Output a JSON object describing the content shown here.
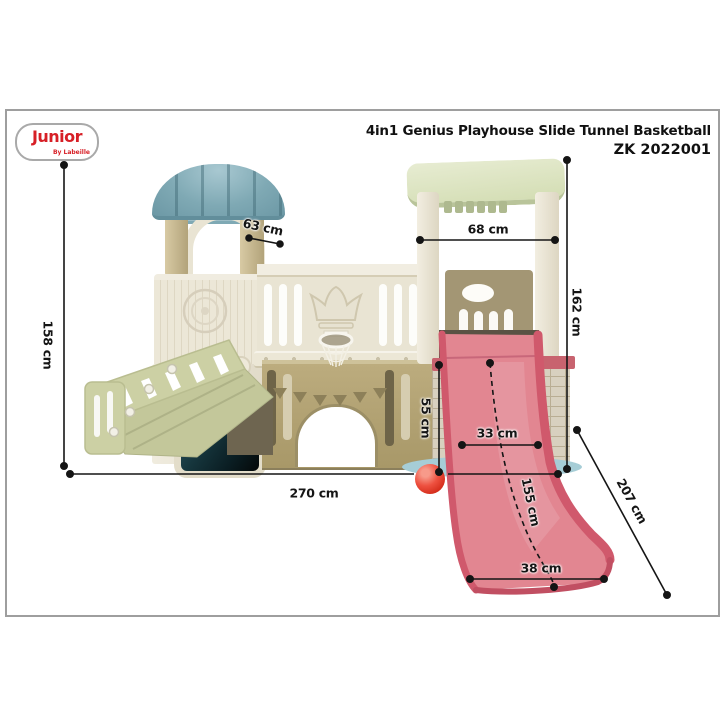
{
  "brand": {
    "logo_text": "Junior",
    "logo_tagline": "By Labeille",
    "logo_color": "#d71f26"
  },
  "header": {
    "title_line1": "4in1 Genius Playhouse Slide Tunnel Basketball",
    "title_line2": "ZK 2022001"
  },
  "product": {
    "tower_plaque": "1616",
    "features": [
      "playhouse",
      "slide",
      "tunnel",
      "basketball"
    ]
  },
  "dimensions": {
    "total_height": {
      "label": "158 cm"
    },
    "total_width": {
      "label": "270 cm"
    },
    "left_tower_depth": {
      "label": "63 cm"
    },
    "right_tower_width": {
      "label": "68 cm"
    },
    "right_tower_height": {
      "label": "162 cm"
    },
    "slide_platform_height": {
      "label": "55 cm"
    },
    "slide_width": {
      "label": "33 cm"
    },
    "slide_length": {
      "label": "155 cm"
    },
    "slide_span_diagonal": {
      "label": "207 cm"
    },
    "slide_exit_width": {
      "label": "38 cm"
    }
  },
  "colors": {
    "brand_red": "#d71f26",
    "roof_teal": "#7fa9b4",
    "canopy_green": "#d9e2bf",
    "body_cream": "#e9e4d3",
    "wall_tan": "#b3a477",
    "slide_pink": "#e28691",
    "stairs_sage": "#ccd0a4",
    "ball_red": "#e8402e",
    "base_blue": "#a6cdd6",
    "annotation": "#151515"
  }
}
